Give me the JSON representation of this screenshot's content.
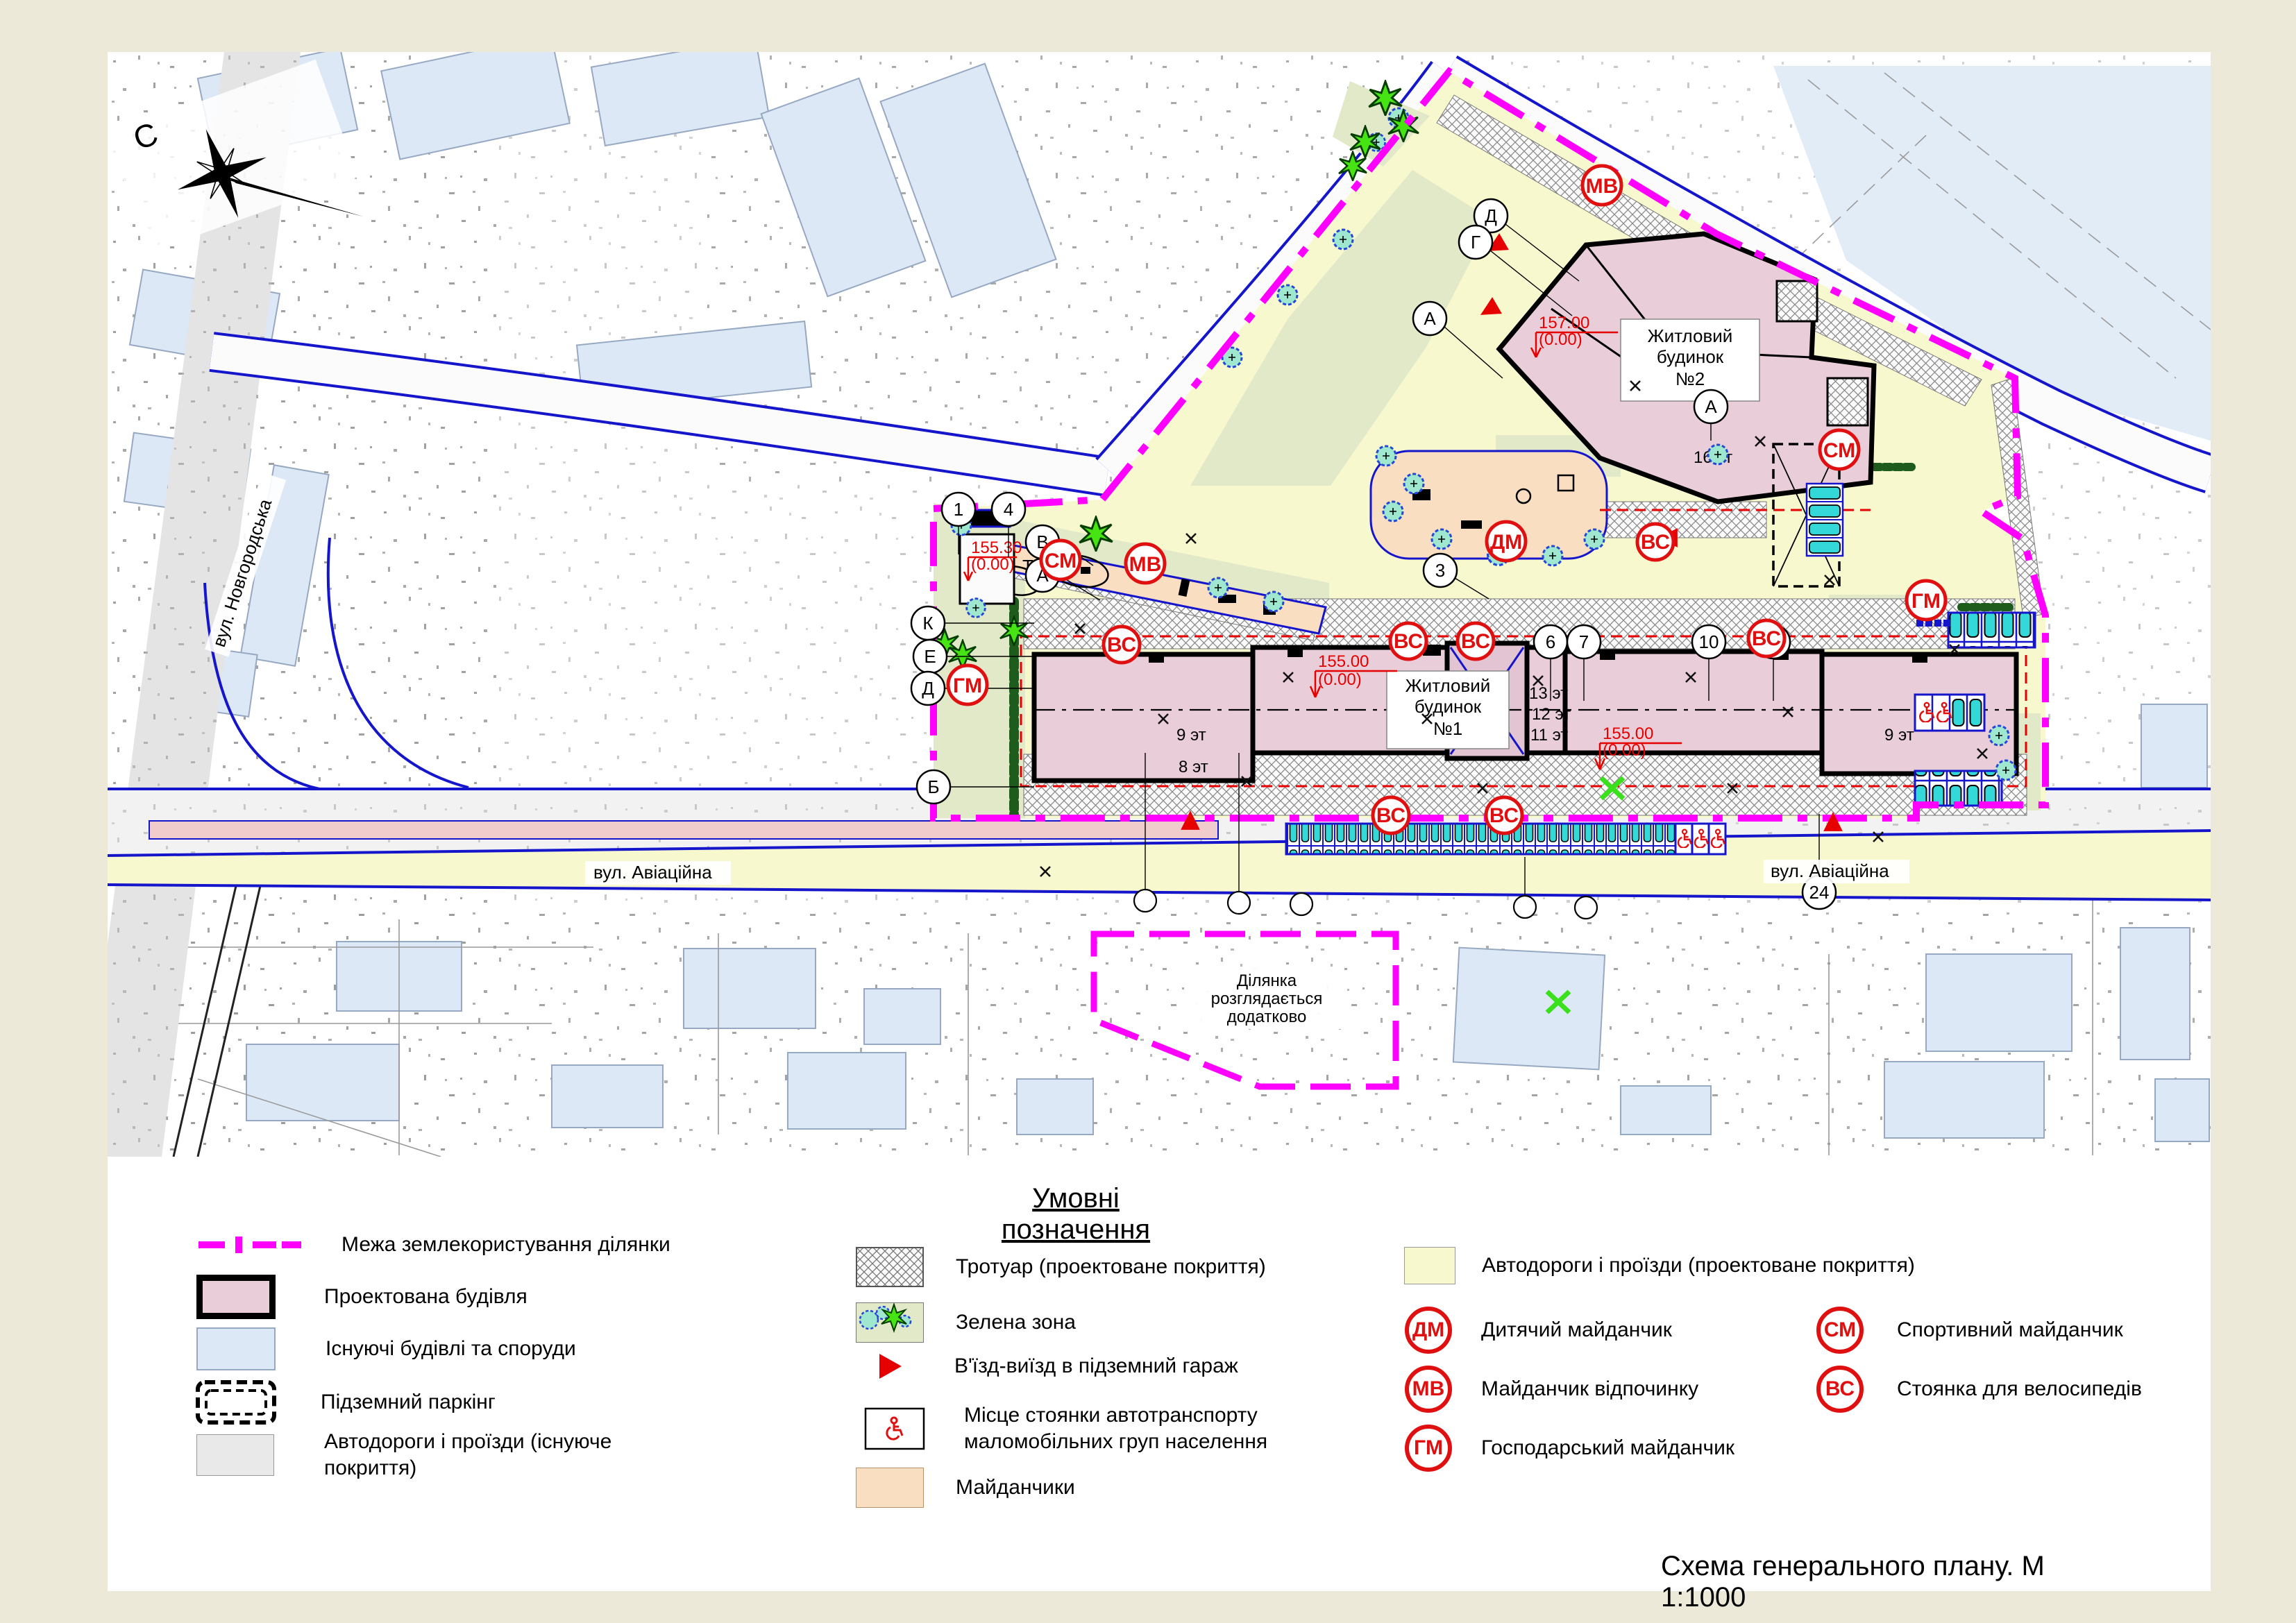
{
  "page": {
    "title_block": "Схема  генерального плану. М 1:1000"
  },
  "legend": {
    "title": "Умовні позначення",
    "col1": [
      {
        "label": "Межа землекористування ділянки"
      },
      {
        "label": "Проектована будівля"
      },
      {
        "label": "Існуючі будівлі та споруди"
      },
      {
        "label": "Підземний паркінг"
      },
      {
        "label": "Автодороги і проїзди (існуюче покриття)"
      }
    ],
    "col2": [
      {
        "label": "Тротуар (проектоване покриття)"
      },
      {
        "label": "Зелена зона"
      },
      {
        "label": "В'їзд-виїзд в підземний гараж"
      },
      {
        "label": "Місце стоянки автотранспорту маломобільних груп населення"
      },
      {
        "label": "Майданчики"
      }
    ],
    "col3_road_label": "Автодороги і проїзди (проектоване покриття)",
    "markers": [
      {
        "code": "ДМ",
        "label": "Дитячий майданчик"
      },
      {
        "code": "МВ",
        "label": "Майданчик відпочинку"
      },
      {
        "code": "ГМ",
        "label": "Господарський майданчик"
      },
      {
        "code": "СМ",
        "label": "Спортивний майданчик"
      },
      {
        "code": "ВС",
        "label": "Стоянка для велосипедів"
      }
    ]
  },
  "map": {
    "compass_north": "С",
    "streets": {
      "novhorodska": "вул. Новгородська",
      "aviatsiina": "вул. Авіаційна"
    },
    "buildings": {
      "b1": {
        "lines": [
          "Житловий",
          "будинок",
          "№1"
        ],
        "floors": [
          "9 эт",
          "8 эт",
          "11 эт",
          "12 эт",
          "13 эт"
        ]
      },
      "b2": {
        "lines": [
          "Житловий",
          "будинок",
          "№2"
        ],
        "floors": [
          "16 эт"
        ]
      }
    },
    "elevations": {
      "e1": {
        "top": "155.00",
        "bottom": "(0.00)"
      },
      "e2": {
        "top": "157.00",
        "bottom": "(0.00)"
      },
      "e3": {
        "top": "155.30",
        "bottom": "(0.00)",
        "suffix": "ТП"
      }
    },
    "note_area": {
      "lines": [
        "Ділянка",
        "розглядається",
        "додатково"
      ]
    },
    "axis": {
      "letters": [
        "Д",
        "Г",
        "А",
        "К",
        "Е",
        "Б",
        "В"
      ],
      "numbers": [
        "1",
        "4",
        "3",
        "6",
        "7",
        "10",
        "13",
        "24"
      ]
    },
    "marker_codes": {
      "dm": "ДМ",
      "mv": "МВ",
      "gm": "ГМ",
      "sm": "СМ",
      "vs": "ВС"
    }
  },
  "colors": {
    "boundary": "#ff00ff",
    "projected_building": "#e9cdd9",
    "existing_building": "#dce8f5",
    "existing_road": "#e9e9e9",
    "projected_road": "#f8f8cf",
    "green_zone": "#e2e9c8",
    "playground": "#f9dec1",
    "marker_red": "#e01010",
    "road_edge_blue": "#1515cc",
    "car_cyan": "#35d8d8"
  }
}
